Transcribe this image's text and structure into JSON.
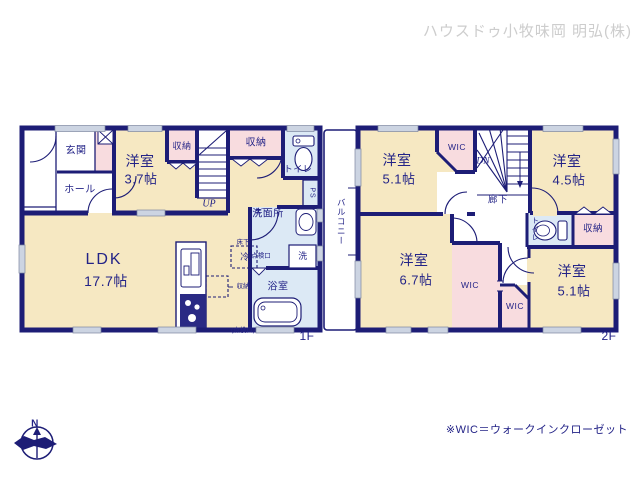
{
  "watermark": "ハウスドゥ小牧味岡 明弘(株)",
  "footnote": "※WIC＝ウォークインクローゼット",
  "compass": {
    "north": "N"
  },
  "colors": {
    "wall": "#1d1d76",
    "room": "#f6e8c2",
    "closet": "#f8dcdf",
    "wet": "#dce9f5",
    "text": "#232387"
  },
  "floor1": {
    "floor_label": "1F",
    "entrance": "玄関",
    "hall": "ホール",
    "bedroom": {
      "name": "洋室",
      "size": "3.7帖"
    },
    "closet_left": "収納",
    "closet_right": "収納",
    "toilet": "トイレ",
    "pipe_space": "PS",
    "washroom": "洗面所",
    "underfloor_hatch": [
      "床下",
      "点検口"
    ],
    "fridge": "冷",
    "washer": "洗",
    "bath": "浴室",
    "underfloor_storage": [
      "床下",
      "収納",
      "(点検口)"
    ],
    "ldk": {
      "name": "LDK",
      "size": "17.7帖"
    },
    "stairs": "UP"
  },
  "floor2": {
    "floor_label": "2F",
    "balcony": "バルコニー",
    "bedroom_nw": {
      "name": "洋室",
      "size": "5.1帖"
    },
    "wic_top": "WIC",
    "stairs": "DN",
    "corridor": "廊下",
    "bedroom_ne": {
      "name": "洋室",
      "size": "4.5帖"
    },
    "toilet": "トイレ",
    "closet": "収納",
    "bedroom_sw": {
      "name": "洋室",
      "size": "6.7帖"
    },
    "wic_mid": "WIC",
    "wic_low": "WIC",
    "bedroom_se": {
      "name": "洋室",
      "size": "5.1帖"
    }
  }
}
